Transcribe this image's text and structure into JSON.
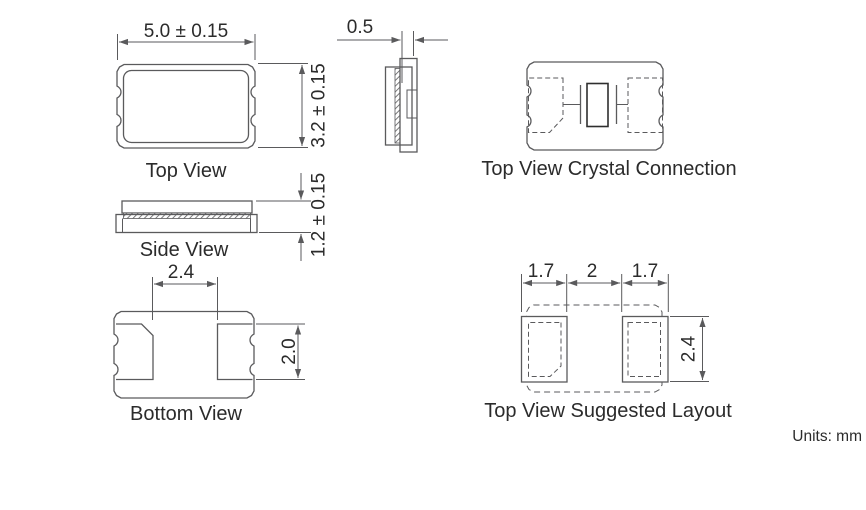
{
  "drawing": {
    "units_label": "Units: mm",
    "top_view": {
      "label": "Top View",
      "width_dim": "5.0 ± 0.15",
      "height_dim": "3.2 ± 0.15"
    },
    "side_view": {
      "label": "Side View",
      "thickness_dim": "1.2 ± 0.15"
    },
    "end_view": {
      "lid_thickness_dim": "0.5"
    },
    "bottom_view": {
      "label": "Bottom View",
      "pad_spacing_dim": "2.4",
      "pad_length_dim": "2.0"
    },
    "crystal_connection": {
      "label": "Top View Crystal Connection"
    },
    "suggested_layout": {
      "label": "Top View Suggested Layout",
      "left_pad_width_dim": "1.7",
      "pad_gap_dim": "2",
      "right_pad_width_dim": "1.7",
      "pad_height_dim": "2.4"
    },
    "colors": {
      "background": "#ffffff",
      "line": "#5a5a5c",
      "dark_line": "#2f2f2f",
      "text": "#2b2b2b"
    }
  }
}
